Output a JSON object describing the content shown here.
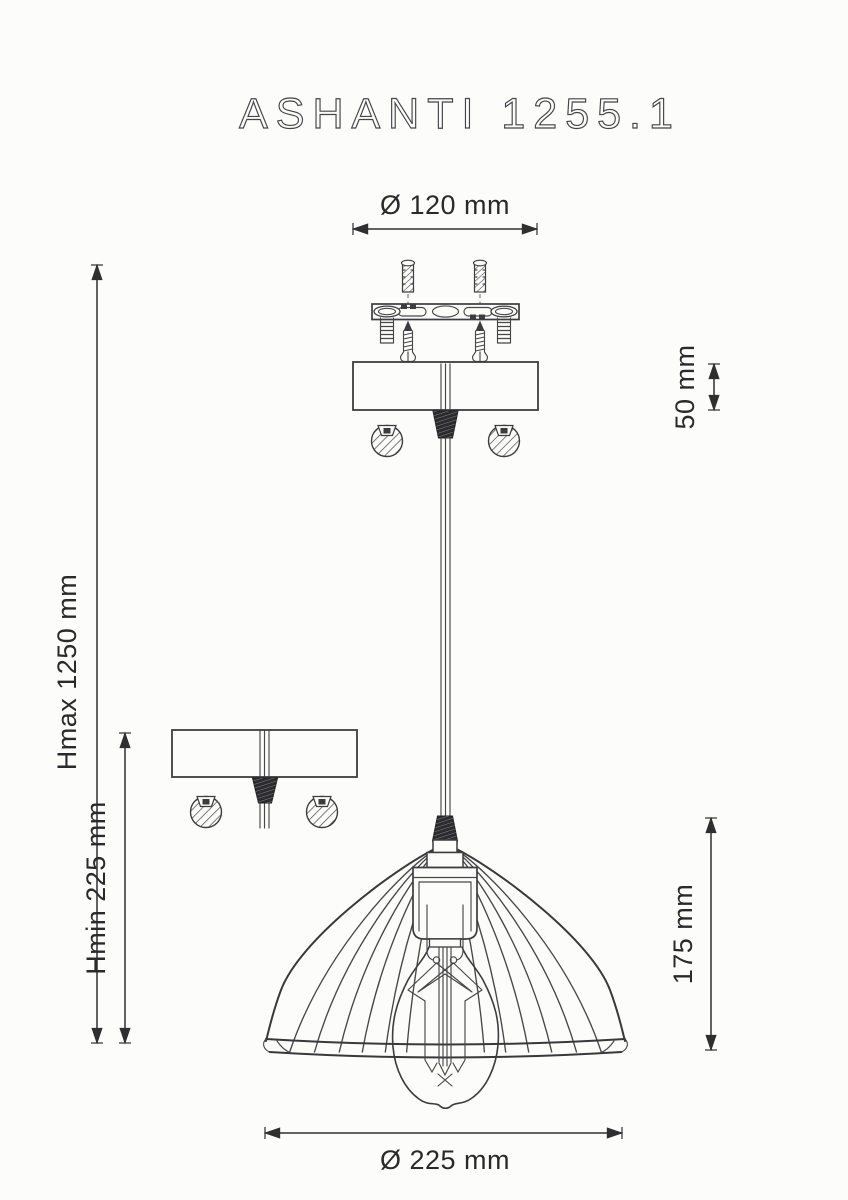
{
  "title": "ASHANTI 1255.1",
  "dimensions": {
    "canopy_diameter": "Ø 120 mm",
    "canopy_height": "50 mm",
    "max_height": "Hmax 1250 mm",
    "min_height": "Hmin 225 mm",
    "shade_height": "175 mm",
    "shade_diameter": "Ø 225 mm"
  },
  "colors": {
    "background": "#fcfcfa",
    "line": "#3d3d40",
    "dimension_text": "#2a2a2c",
    "dark_fill": "#2c2c2f"
  }
}
